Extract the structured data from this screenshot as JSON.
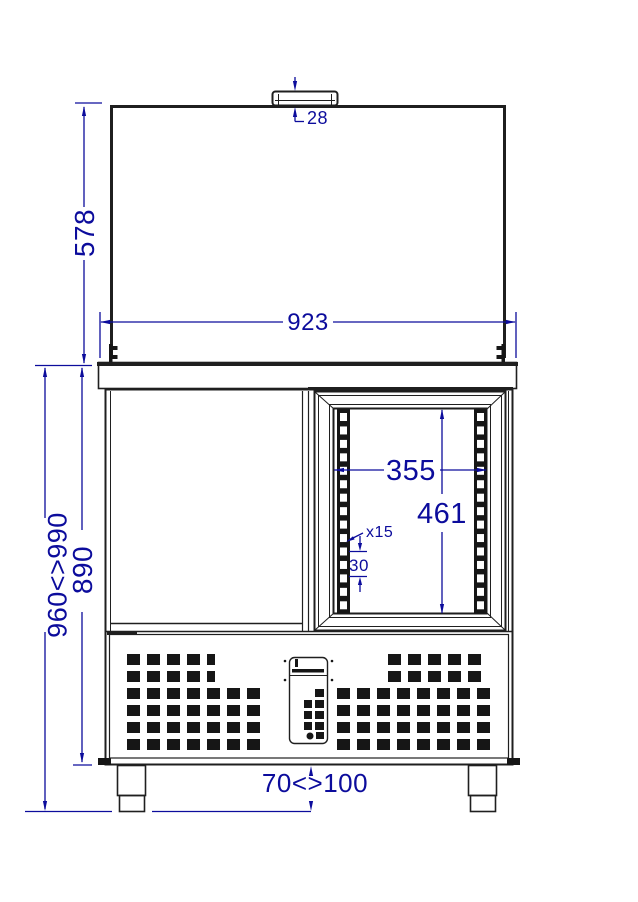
{
  "drawing": {
    "dimensions": {
      "handle_height": "28",
      "lid_height": "578",
      "overall_width": "923",
      "opening_width": "355",
      "opening_height": "461",
      "shelf_positions": "x15",
      "shelf_pitch": "30",
      "body_height": "890",
      "total_height_range": "960<>990",
      "feet_height_range": "70<>100"
    },
    "colors": {
      "dimension_blue": "#0c0c9c",
      "line_black": "#1f1f1f"
    },
    "rails": {
      "count": 15,
      "y0": 413,
      "pitch": 13.45,
      "slot_h": 8,
      "slot_w": 7,
      "xs": [
        340,
        477
      ]
    },
    "grille": {
      "slot_w": 13,
      "slot_h": 11,
      "pitch": 20,
      "rows": [
        {
          "y": 654,
          "blocks": [
            {
              "x": 127,
              "n": 4
            },
            {
              "x": 207,
              "n": 1,
              "w": 8
            },
            {
              "x": 388,
              "n": 5
            }
          ]
        },
        {
          "y": 671,
          "blocks": [
            {
              "x": 127,
              "n": 4
            },
            {
              "x": 207,
              "n": 1,
              "w": 8
            },
            {
              "x": 388,
              "n": 5
            }
          ]
        },
        {
          "y": 688,
          "blocks": [
            {
              "x": 127,
              "n": 7
            },
            {
              "x": 337,
              "n": 8
            }
          ]
        },
        {
          "y": 705,
          "blocks": [
            {
              "x": 127,
              "n": 7
            },
            {
              "x": 337,
              "n": 8
            }
          ]
        },
        {
          "y": 722,
          "blocks": [
            {
              "x": 127,
              "n": 7
            },
            {
              "x": 337,
              "n": 8
            }
          ]
        },
        {
          "y": 739,
          "blocks": [
            {
              "x": 127,
              "n": 7
            },
            {
              "x": 337,
              "n": 8
            }
          ]
        }
      ]
    }
  }
}
